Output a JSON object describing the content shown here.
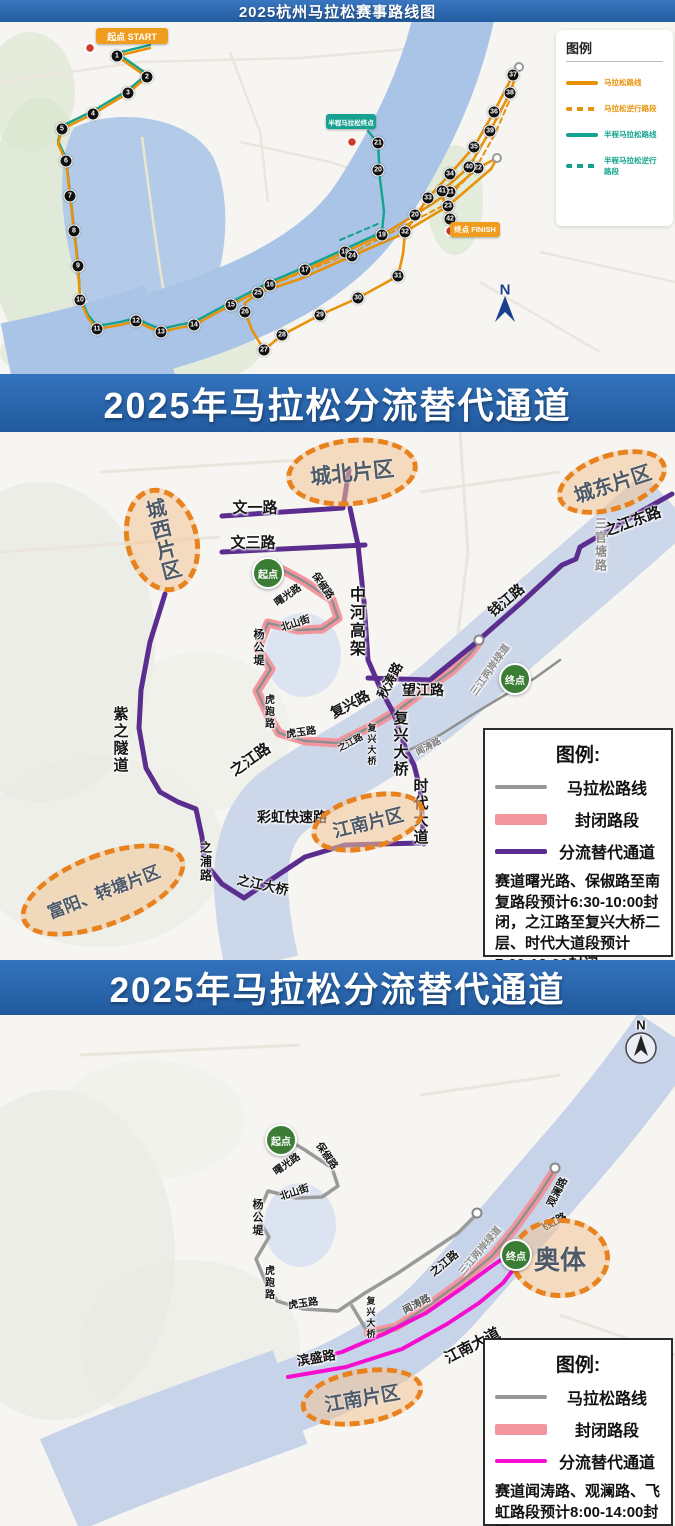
{
  "s1": {
    "title": "2025杭州马拉松赛事路线图",
    "legend": {
      "title": "图例",
      "items": [
        {
          "label": "马拉松路线",
          "color": "#e8920a",
          "style": "solid",
          "lw": 4
        },
        {
          "label": "马拉松逆行路段",
          "color": "#e8920a",
          "style": "dashed",
          "lw": 4
        },
        {
          "label": "半程马拉松路线",
          "color": "#14a38e",
          "style": "solid",
          "lw": 4
        },
        {
          "label": "半程马拉松逆行路段",
          "color": "#14a38e",
          "style": "dashed",
          "lw": 4
        }
      ]
    },
    "badges": [
      {
        "id": "start",
        "text": "起点 START",
        "x": 96,
        "y": 6,
        "w": 72,
        "h": 16,
        "bg": "#f09c1e",
        "fs": 9
      },
      {
        "id": "half-finish",
        "text": "半程马拉松终点",
        "x": 326,
        "y": 92,
        "w": 50,
        "h": 15,
        "bg": "#16a191",
        "fs": 6.5
      },
      {
        "id": "finish",
        "text": "终点 FINISH",
        "x": 450,
        "y": 200,
        "w": 50,
        "h": 15,
        "bg": "#f09c1e",
        "fs": 7.5
      }
    ],
    "labels": [
      {
        "t": "N",
        "x": 505,
        "y": 268,
        "s": 15,
        "c": "#1b3f8f"
      }
    ],
    "markers": [
      {
        "n": 1,
        "x": 117,
        "y": 34
      },
      {
        "n": 2,
        "x": 147,
        "y": 55
      },
      {
        "n": 3,
        "x": 128,
        "y": 71
      },
      {
        "n": 4,
        "x": 93,
        "y": 92
      },
      {
        "n": 5,
        "x": 62,
        "y": 107
      },
      {
        "n": 6,
        "x": 66,
        "y": 139
      },
      {
        "n": 7,
        "x": 70,
        "y": 174
      },
      {
        "n": 8,
        "x": 74,
        "y": 209
      },
      {
        "n": 9,
        "x": 78,
        "y": 244
      },
      {
        "n": 10,
        "x": 80,
        "y": 278
      },
      {
        "n": 11,
        "x": 97,
        "y": 307
      },
      {
        "n": 12,
        "x": 136,
        "y": 299
      },
      {
        "n": 13,
        "x": 161,
        "y": 310
      },
      {
        "n": 14,
        "x": 194,
        "y": 303
      },
      {
        "n": 15,
        "x": 231,
        "y": 283
      },
      {
        "n": 16,
        "x": 270,
        "y": 263
      },
      {
        "n": 17,
        "x": 305,
        "y": 248
      },
      {
        "n": 18,
        "x": 345,
        "y": 230
      },
      {
        "n": 19,
        "x": 382,
        "y": 213
      },
      {
        "n": 20,
        "x": 415,
        "y": 193
      },
      {
        "n": 21,
        "x": 450,
        "y": 170
      },
      {
        "n": 22,
        "x": 478,
        "y": 146
      },
      {
        "n": 23,
        "x": 448,
        "y": 184
      },
      {
        "n": 24,
        "x": 352,
        "y": 234
      },
      {
        "n": 25,
        "x": 258,
        "y": 271
      },
      {
        "n": 26,
        "x": 245,
        "y": 290
      },
      {
        "n": 27,
        "x": 264,
        "y": 328
      },
      {
        "n": 28,
        "x": 282,
        "y": 313
      },
      {
        "n": 29,
        "x": 320,
        "y": 293
      },
      {
        "n": 30,
        "x": 358,
        "y": 276
      },
      {
        "n": 31,
        "x": 398,
        "y": 254
      },
      {
        "n": 32,
        "x": 405,
        "y": 210
      },
      {
        "n": 33,
        "x": 428,
        "y": 176
      },
      {
        "n": 34,
        "x": 450,
        "y": 152
      },
      {
        "n": 35,
        "x": 474,
        "y": 125
      },
      {
        "n": 36,
        "x": 494,
        "y": 90
      },
      {
        "n": 37,
        "x": 513,
        "y": 53
      },
      {
        "n": 38,
        "x": 510,
        "y": 71
      },
      {
        "n": 39,
        "x": 490,
        "y": 109
      },
      {
        "n": 40,
        "x": 469,
        "y": 145
      },
      {
        "n": 41,
        "x": 442,
        "y": 169
      },
      {
        "n": 42,
        "x": 450,
        "y": 197
      },
      {
        "n": 20,
        "x": 378,
        "y": 148,
        "half": true
      },
      {
        "n": 21,
        "x": 378,
        "y": 121,
        "half": true
      }
    ]
  },
  "s2": {
    "banner": "2025年马拉松分流替代通道",
    "legend": {
      "title": "图例:",
      "items": [
        {
          "label": "马拉松路线",
          "color": "#979797",
          "style": "solid",
          "lw": 4
        },
        {
          "label": "封闭路段",
          "color": "#f2959d",
          "style": "solid",
          "lw": 11
        },
        {
          "label": "分流替代通道",
          "color": "#5b2d8e",
          "style": "solid",
          "lw": 5
        }
      ],
      "note": "赛道曙光路、保俶路至南复路段预计6:30-10:00封闭，之江路至复兴大桥二层、时代大道段预计7:00-12:00封闭。"
    },
    "districts": [
      {
        "name": "城北片区",
        "x": 352,
        "y": 40,
        "rx": 66,
        "ry": 34,
        "rot": -6,
        "fs": 21
      },
      {
        "name": "城东片区",
        "x": 612,
        "y": 50,
        "rx": 57,
        "ry": 29,
        "rot": -18,
        "fs": 20
      },
      {
        "name": "城西片区",
        "x": 162,
        "y": 108,
        "rx": 37,
        "ry": 53,
        "rot": -14,
        "fs": 20,
        "vertical": true
      },
      {
        "name": "江南片区",
        "x": 368,
        "y": 390,
        "rx": 58,
        "ry": 28,
        "rot": -14,
        "fs": 18
      },
      {
        "name": "富阳、转塘片区",
        "x": 103,
        "y": 458,
        "rx": 87,
        "ry": 37,
        "rot": -21,
        "fs": 17
      }
    ],
    "points": [
      {
        "label": "起点",
        "x": 268,
        "y": 141
      },
      {
        "label": "终点",
        "x": 515,
        "y": 247
      }
    ],
    "labels": [
      {
        "t": "文一路",
        "x": 255,
        "y": 75,
        "s": 15
      },
      {
        "t": "文三路",
        "x": 253,
        "y": 110,
        "s": 15
      },
      {
        "t": "中河高架",
        "x": 355,
        "y": 190,
        "s": 16,
        "v": true
      },
      {
        "t": "曙光路",
        "x": 287,
        "y": 162,
        "r": -35,
        "s": 10
      },
      {
        "t": "保俶路",
        "x": 324,
        "y": 153,
        "r": 55,
        "s": 10
      },
      {
        "t": "北山街",
        "x": 295,
        "y": 190,
        "r": -18,
        "s": 10
      },
      {
        "t": "杨公堤",
        "x": 258,
        "y": 216,
        "s": 11,
        "v": true
      },
      {
        "t": "秋涛路",
        "x": 389,
        "y": 248,
        "r": -62,
        "s": 13
      },
      {
        "t": "望江路",
        "x": 423,
        "y": 258,
        "s": 14
      },
      {
        "t": "钱江路",
        "x": 506,
        "y": 168,
        "r": -40,
        "s": 14
      },
      {
        "t": "之江东路",
        "x": 632,
        "y": 89,
        "r": -20,
        "s": 15
      },
      {
        "t": "三官塘路",
        "x": 601,
        "y": 113,
        "s": 12,
        "v": true,
        "c": "#8a8a8a"
      },
      {
        "t": "复兴路",
        "x": 350,
        "y": 272,
        "r": -28,
        "s": 14
      },
      {
        "t": "虎跑路",
        "x": 268,
        "y": 280,
        "s": 10,
        "v": true
      },
      {
        "t": "虎玉路",
        "x": 301,
        "y": 299,
        "r": -8,
        "s": 10
      },
      {
        "t": "之江路",
        "x": 250,
        "y": 327,
        "r": -35,
        "s": 15
      },
      {
        "t": "之江路",
        "x": 350,
        "y": 310,
        "r": -28,
        "s": 9
      },
      {
        "t": "复兴大桥",
        "x": 372,
        "y": 313,
        "s": 9,
        "v": true
      },
      {
        "t": "闻涛路",
        "x": 428,
        "y": 314,
        "r": -28,
        "s": 9,
        "c": "#777777"
      },
      {
        "t": "复兴大桥",
        "x": 400,
        "y": 312,
        "s": 15,
        "v": true
      },
      {
        "t": "紫之隧道",
        "x": 120,
        "y": 308,
        "s": 15,
        "v": true
      },
      {
        "t": "彩虹快速路",
        "x": 292,
        "y": 385,
        "s": 14
      },
      {
        "t": "之浦路",
        "x": 206,
        "y": 430,
        "s": 12,
        "v": true
      },
      {
        "t": "之江大桥",
        "x": 263,
        "y": 452,
        "r": 12,
        "s": 13
      },
      {
        "t": "时代大道",
        "x": 420,
        "y": 380,
        "s": 15,
        "v": true
      },
      {
        "t": "三江两岸绿道",
        "x": 489,
        "y": 237,
        "r": -55,
        "s": 10,
        "c": "#8a8a8a"
      }
    ]
  },
  "s3": {
    "banner": "2025年马拉松分流替代通道",
    "legend": {
      "title": "图例:",
      "items": [
        {
          "label": "马拉松路线",
          "color": "#979797",
          "style": "solid",
          "lw": 4
        },
        {
          "label": "封闭路段",
          "color": "#f2959d",
          "style": "solid",
          "lw": 11
        },
        {
          "label": "分流替代通道",
          "color": "#f50dd0",
          "style": "solid",
          "lw": 4
        }
      ],
      "note": "赛道闻涛路、观澜路、飞虹路段预计8:00-14:00封闭。"
    },
    "districts": [
      {
        "name": "奥体",
        "x": 560,
        "y": 243,
        "rx": 50,
        "ry": 40,
        "rot": 0,
        "fs": 26
      },
      {
        "name": "江南片区",
        "x": 362,
        "y": 382,
        "rx": 62,
        "ry": 28,
        "rot": -10,
        "fs": 19
      }
    ],
    "points": [
      {
        "label": "起点",
        "x": 281,
        "y": 125
      },
      {
        "label": "终点",
        "x": 516,
        "y": 240
      }
    ],
    "labels": [
      {
        "t": "曙光路",
        "x": 286,
        "y": 148,
        "r": -35,
        "s": 10
      },
      {
        "t": "保俶路",
        "x": 328,
        "y": 140,
        "r": 55,
        "s": 10
      },
      {
        "t": "北山街",
        "x": 294,
        "y": 176,
        "r": -18,
        "s": 10
      },
      {
        "t": "杨公堤",
        "x": 257,
        "y": 203,
        "s": 11,
        "v": true
      },
      {
        "t": "虎跑路",
        "x": 268,
        "y": 268,
        "s": 10,
        "v": true
      },
      {
        "t": "虎玉路",
        "x": 303,
        "y": 287,
        "r": -8,
        "s": 10
      },
      {
        "t": "之江路",
        "x": 444,
        "y": 248,
        "r": -40,
        "s": 11
      },
      {
        "t": "三江两岸绿道",
        "x": 479,
        "y": 235,
        "r": -50,
        "s": 10,
        "c": "#8a8a8a"
      },
      {
        "t": "闻涛路",
        "x": 416,
        "y": 288,
        "r": -28,
        "s": 10,
        "c": "#555555"
      },
      {
        "t": "复兴大桥",
        "x": 371,
        "y": 303,
        "s": 9,
        "v": true
      },
      {
        "t": "观澜路",
        "x": 557,
        "y": 177,
        "r": -62,
        "s": 10.5
      },
      {
        "t": "飞虹路",
        "x": 552,
        "y": 208,
        "r": -28,
        "s": 10.5
      },
      {
        "t": "江南大道",
        "x": 472,
        "y": 330,
        "r": -27,
        "s": 15
      },
      {
        "t": "滨盛路",
        "x": 316,
        "y": 342,
        "r": -10,
        "s": 13
      },
      {
        "t": "N",
        "x": 641,
        "y": 10,
        "s": 13,
        "c": "#111111"
      }
    ]
  }
}
